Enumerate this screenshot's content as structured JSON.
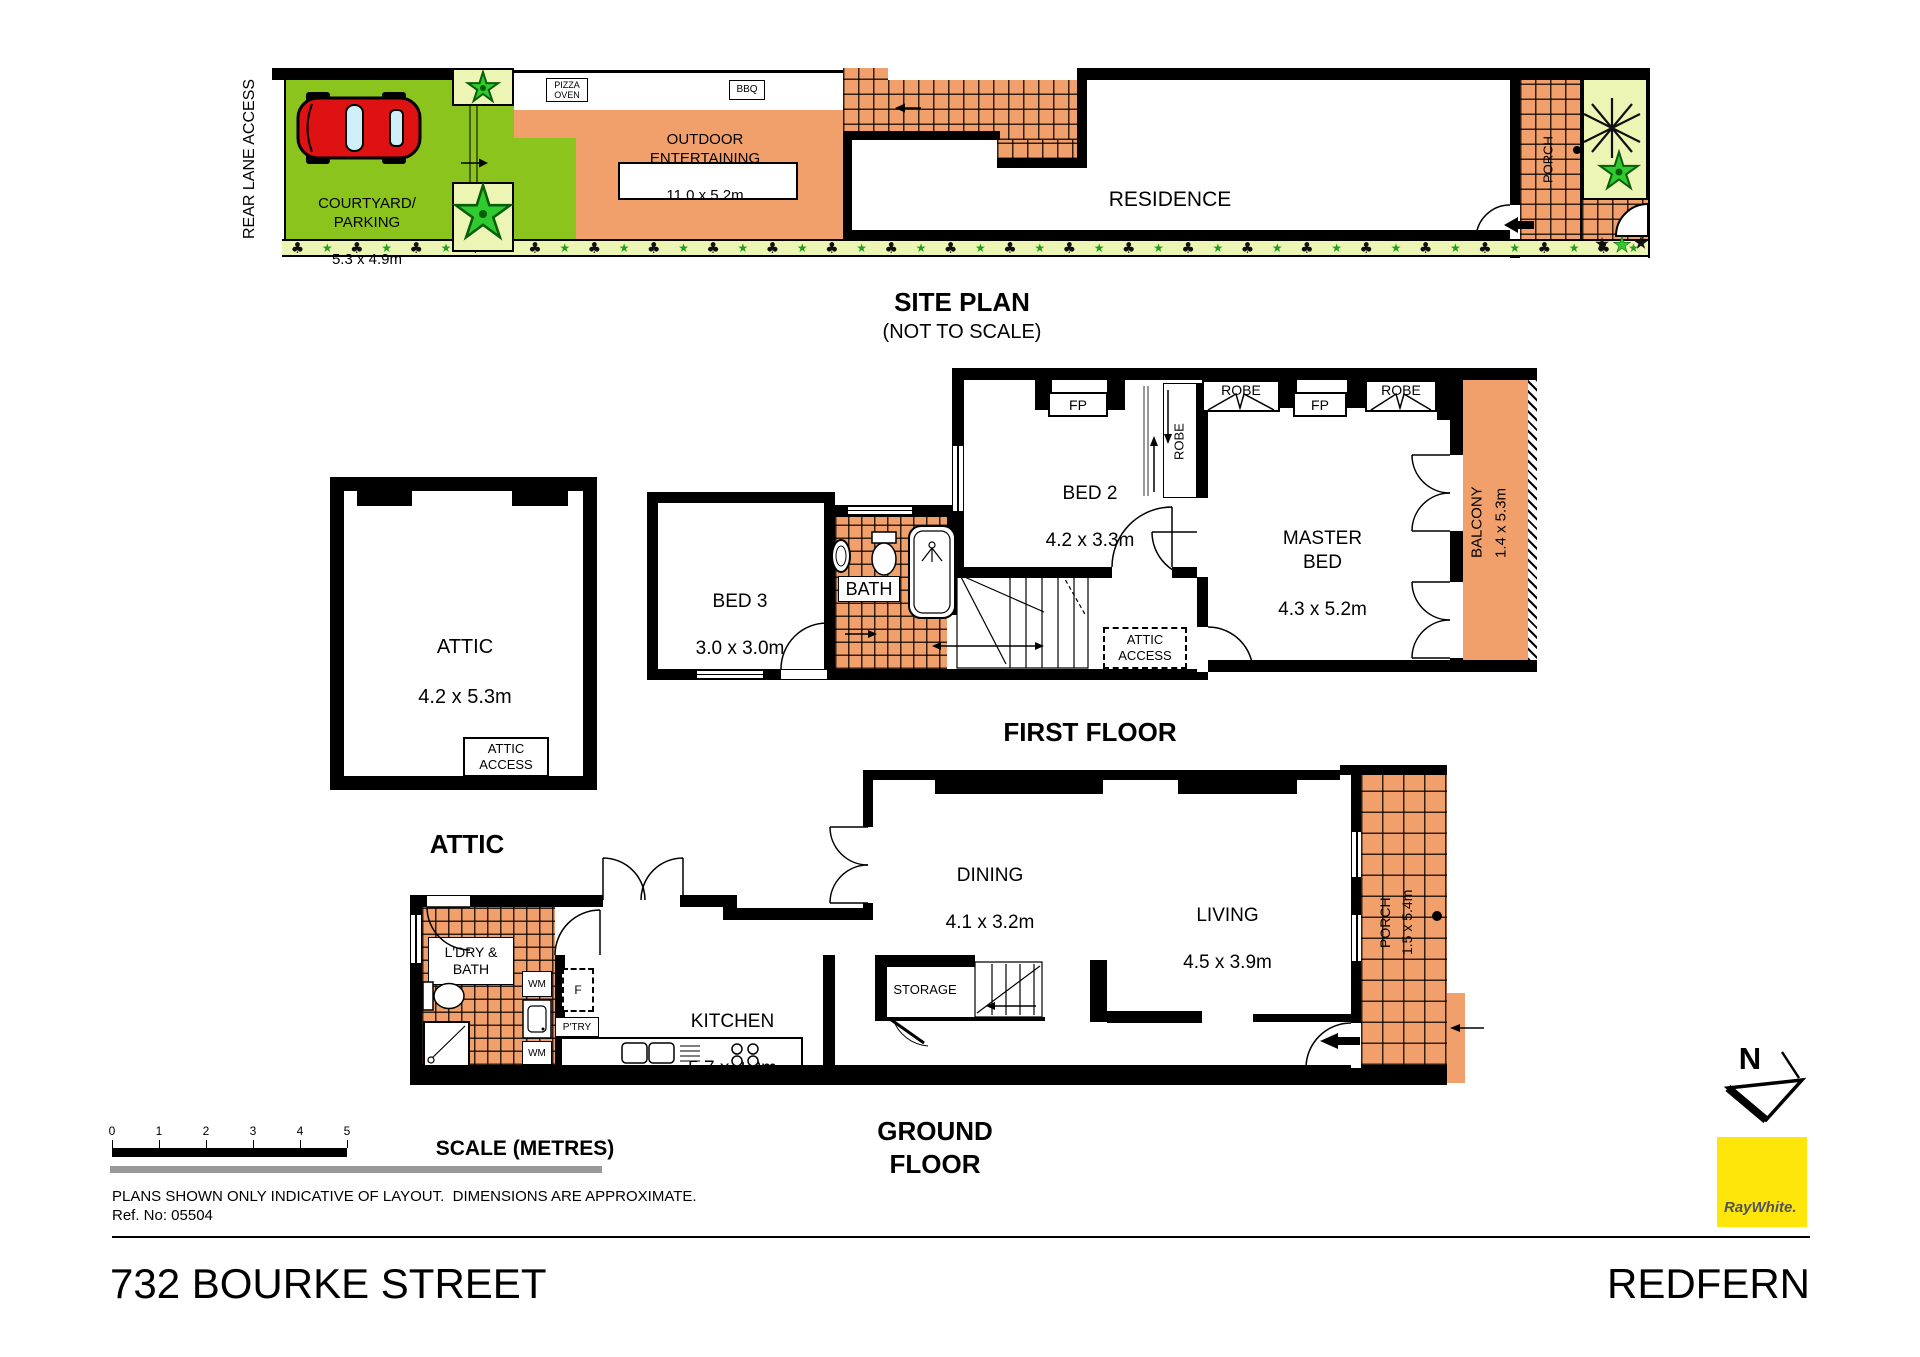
{
  "colors": {
    "grass": "#8CC41E",
    "pale_green": "#EDF5B5",
    "tile_orange": "#F2A06B",
    "wall": "#000000",
    "brand_yellow": "#FFE60A",
    "brand_text": "#50555A",
    "scale_gray": "#999999",
    "car_red": "#DE1212"
  },
  "site": {
    "title": "SITE PLAN",
    "subtitle": "(NOT TO SCALE)",
    "rear_lane": "REAR LANE ACCESS",
    "courtyard_name": "COURTYARD/\nPARKING",
    "courtyard_dims": "5.3 x 4.9m",
    "pizza_oven": "PIZZA\nOVEN",
    "bbq": "BBQ",
    "outdoor_name": "OUTDOOR\nENTERTAINING",
    "outdoor_dims": "11.0 x 5.2m",
    "residence": "RESIDENCE",
    "porch": "PORCH"
  },
  "first": {
    "title": "FIRST FLOOR",
    "bed2_name": "BED 2",
    "bed2_dims": "4.2 x 3.3m",
    "bed3_name": "BED 3",
    "bed3_dims": "3.0 x 3.0m",
    "bath": "BATH",
    "master_name": "MASTER\nBED",
    "master_dims": "4.3 x 5.2m",
    "balcony_name": "BALCONY",
    "balcony_dims": "1.4 x 5.3m",
    "robe": "ROBE",
    "fp": "FP",
    "attic_access": "ATTIC\nACCESS"
  },
  "attic": {
    "room_name": "ATTIC",
    "room_dims": "4.2 x 5.3m",
    "access": "ATTIC\nACCESS",
    "title": "ATTIC"
  },
  "ground": {
    "title": "GROUND FLOOR",
    "ldry": "L'DRY &\nBATH",
    "wm": "WM",
    "fridge": "F",
    "pantry": "P'TRY",
    "kitchen_name": "KITCHEN",
    "kitchen_dims": "5.7 x 3.0m",
    "dining_name": "DINING",
    "dining_dims": "4.1 x 3.2m",
    "living_name": "LIVING",
    "living_dims": "4.5 x 3.9m",
    "storage": "STORAGE",
    "porch_name": "PORCH",
    "porch_dims": "1.5 x 5.4m"
  },
  "footer": {
    "scale_title": "SCALE (METRES)",
    "ticks": [
      "0",
      "1",
      "2",
      "3",
      "4",
      "5"
    ],
    "disclaimer": "PLANS SHOWN ONLY INDICATIVE OF LAYOUT.  DIMENSIONS ARE APPROXIMATE.",
    "ref": "Ref. No: 05504",
    "address": "732 BOURKE STREET",
    "suburb": "REDFERN",
    "north": "N",
    "brand": "RayWhite."
  }
}
